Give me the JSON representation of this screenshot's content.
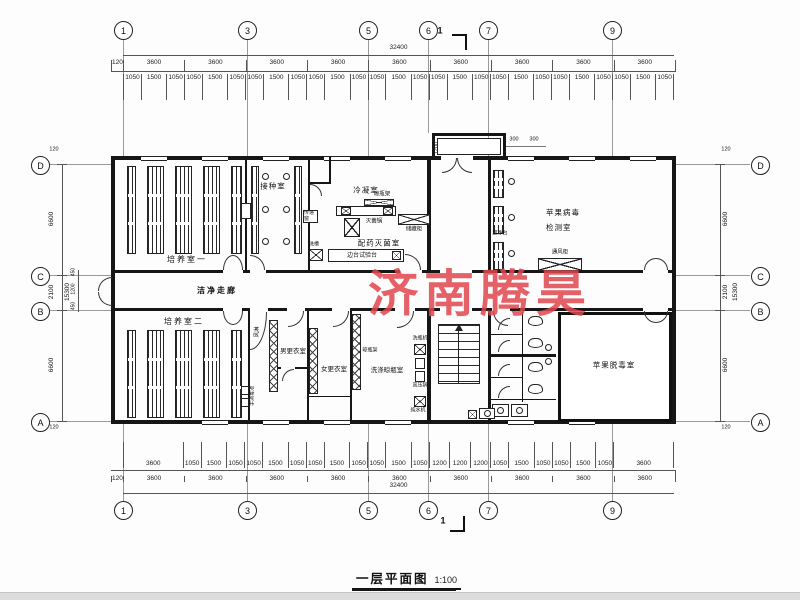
{
  "watermark": {
    "text": "济南腾昊",
    "color": "#e0474e"
  },
  "title_block": {
    "title": "一层平面图",
    "scale": "1:100"
  },
  "section_marker": "1",
  "axis_bubbles": {
    "top": [
      "1",
      "3",
      "5",
      "6",
      "7",
      "9"
    ],
    "bottom": [
      "1",
      "3",
      "5",
      "6",
      "7",
      "9"
    ],
    "left": [
      "D",
      "C",
      "B",
      "A"
    ],
    "right": [
      "D",
      "C",
      "B",
      "A"
    ]
  },
  "dims": {
    "total_width": "32400",
    "total_height": "15300",
    "wall_edge": "120",
    "top_bays": [
      "120",
      "3600",
      "3600",
      "3600",
      "3600",
      "3600",
      "3600",
      "3600",
      "3600",
      "3600"
    ],
    "top_detail": [
      "1050",
      "1500",
      "1050",
      "1050",
      "1500",
      "1050",
      "1050",
      "1500",
      "1050",
      "1050",
      "1500",
      "1050",
      "1050",
      "1500",
      "1050",
      "1050",
      "1500",
      "1050",
      "1050",
      "1500",
      "1050",
      "1050",
      "1500",
      "1050",
      "1050",
      "1500",
      "1050"
    ],
    "bottom_bays": [
      "120",
      "3600",
      "3600",
      "3600",
      "3600",
      "3600",
      "3600",
      "3600",
      "3600",
      "3600"
    ],
    "bottom_detail": [
      "3600",
      "1050",
      "1500",
      "1050",
      "1050",
      "1500",
      "1050",
      "1050",
      "1500",
      "1050",
      "1050",
      "1500",
      "1050",
      "1200",
      "1200",
      "1200",
      "1050",
      "1500",
      "1050",
      "1050",
      "1500",
      "1050",
      "3600"
    ],
    "left_main": [
      "6600",
      "2100",
      "6600"
    ],
    "left_sub": [
      "450",
      "1200",
      "450"
    ],
    "right_main": [
      "6600",
      "2100",
      "6600"
    ],
    "entrance": {
      "depth": "1200",
      "w1": "300",
      "w2": "300"
    }
  },
  "rooms": {
    "culture1": "培养室一",
    "inoculation": "接种室",
    "condensation": "冷凝室",
    "prep_steril": "配药灭菌室",
    "virus_test_l1": "苹果病毒",
    "virus_test_l2": "检测室",
    "corridor": "洁净走廊",
    "culture2": "培养室二",
    "men_change": "男更衣室",
    "women_change": "女更衣室",
    "washing": "洗涤晾瓶室",
    "detox": "苹果脱毒室"
  },
  "equipment": {
    "pass_box": "传递窗",
    "sterilizer": "灭菌锅",
    "shelf": "晾瓶架",
    "cabinet": "储藏柜",
    "bench": "边台试验台",
    "sink": "洗槽",
    "clean_bench": "超净台",
    "fume_hood": "通风柜",
    "air_shower": "风淋",
    "hand_wash": "手消毒池",
    "bottle_washer": "洗瓶机",
    "autoclave": "高压锅",
    "water_machine": "纯水机"
  }
}
